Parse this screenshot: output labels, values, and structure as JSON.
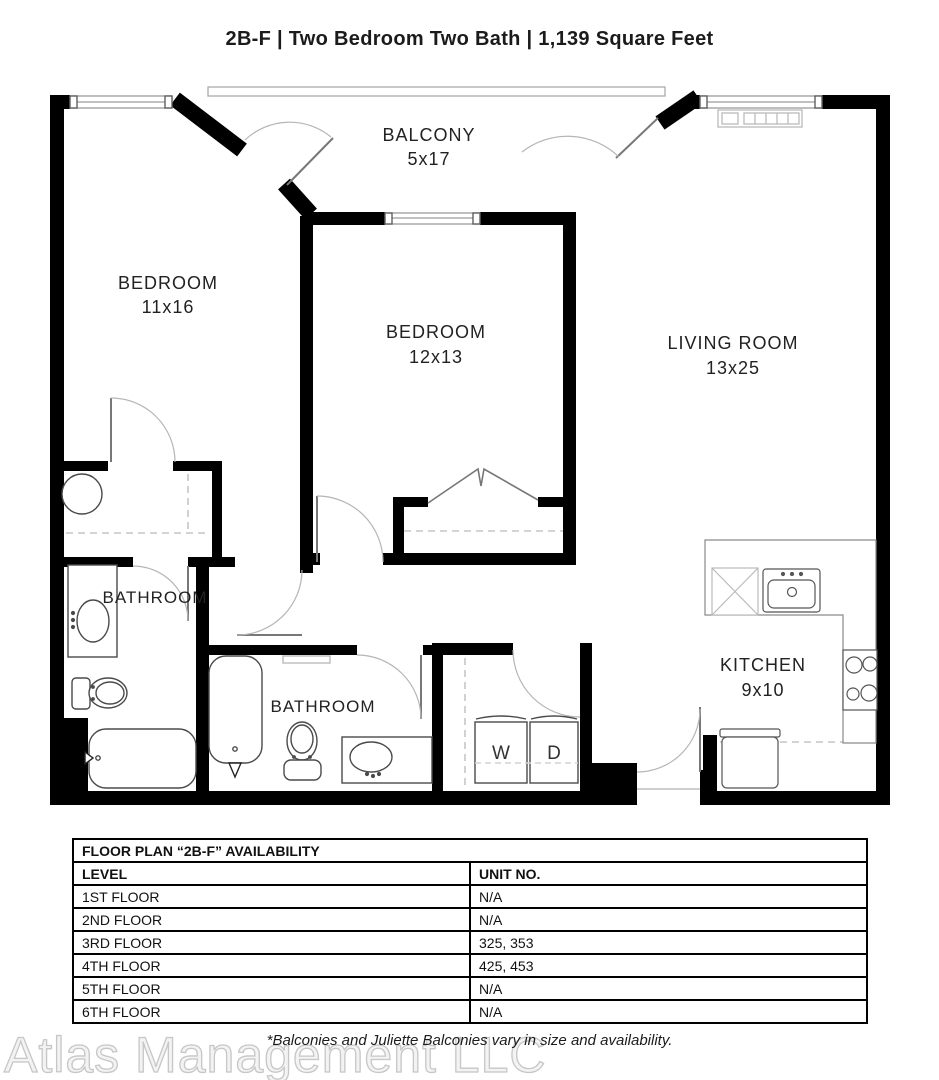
{
  "title": "2B-F | Two Bedroom Two Bath | 1,139 Square Feet",
  "floor_plan": {
    "rooms": {
      "bedroom1": {
        "name": "BEDROOM",
        "dims": "11x16"
      },
      "bedroom2": {
        "name": "BEDROOM",
        "dims": "12x13"
      },
      "living_room": {
        "name": "LIVING ROOM",
        "dims": "13x25"
      },
      "balcony": {
        "name": "BALCONY",
        "dims": "5x17"
      },
      "kitchen": {
        "name": "KITCHEN",
        "dims": "9x10"
      },
      "bathroom1": {
        "name": "BATHROOM"
      },
      "bathroom2": {
        "name": "BATHROOM"
      }
    },
    "appliances": {
      "washer": "W",
      "dryer": "D"
    }
  },
  "availability_table": {
    "title": "FLOOR PLAN “2B-F” AVAILABILITY",
    "columns": [
      "LEVEL",
      "UNIT NO."
    ],
    "rows": [
      [
        "1ST FLOOR",
        "N/A"
      ],
      [
        "2ND FLOOR",
        "N/A"
      ],
      [
        "3RD FLOOR",
        "325, 353"
      ],
      [
        "4TH FLOOR",
        "425, 453"
      ],
      [
        "5TH FLOOR",
        "N/A"
      ],
      [
        "6TH FLOOR",
        "N/A"
      ]
    ]
  },
  "footer": {
    "watermark": "Atlas Management LLC",
    "note": "*Balconies and Juliette Balconies vary in size and availability."
  },
  "colors": {
    "wall": "#000000",
    "fixture": "#4a4a4a",
    "counter": "#8a8a8a",
    "dash": "#c6c6c6"
  }
}
